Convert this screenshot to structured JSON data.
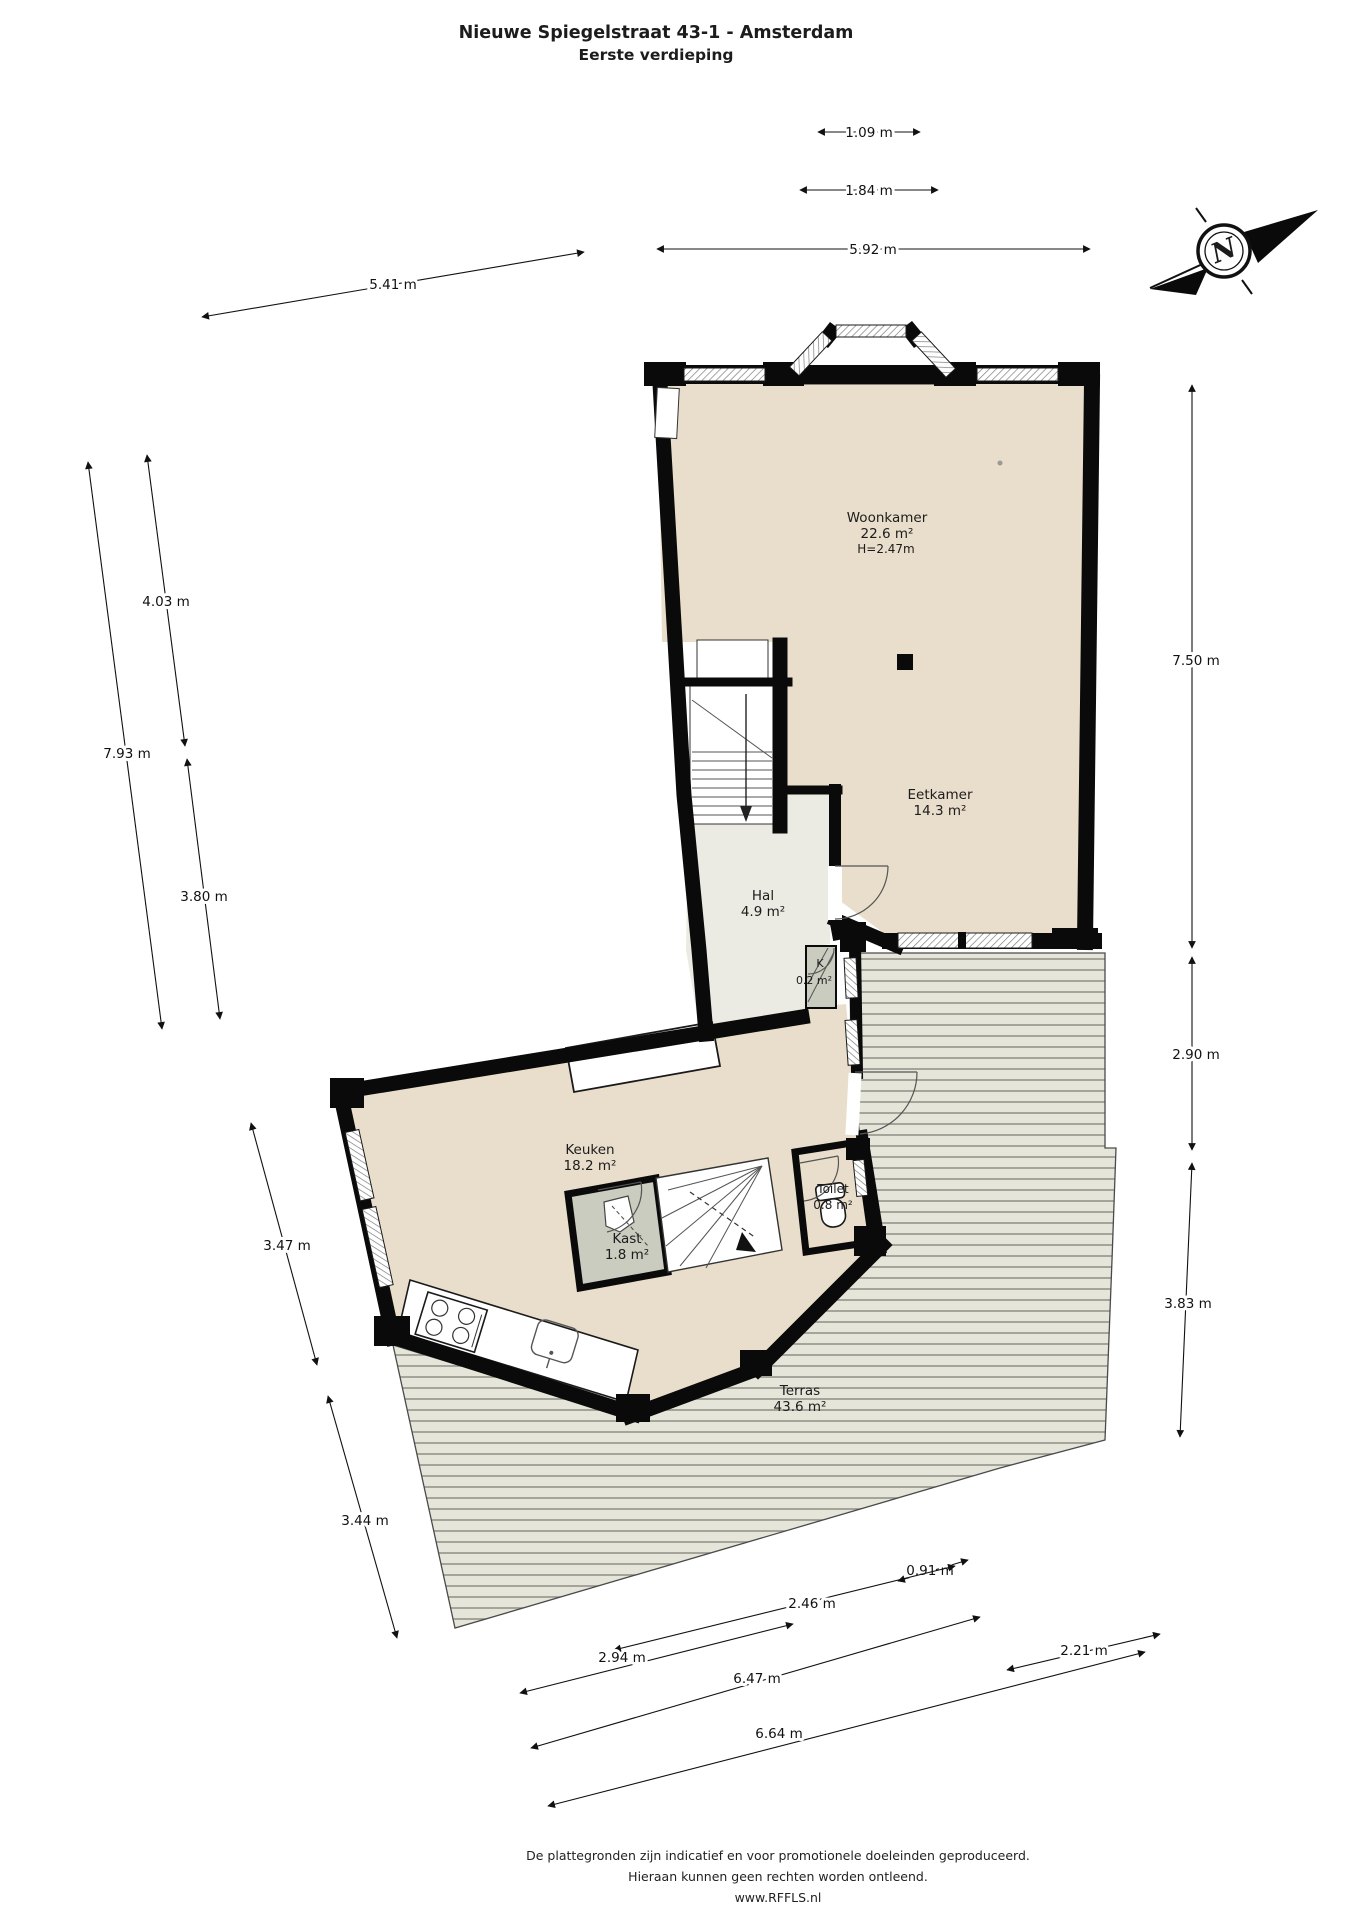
{
  "title": {
    "line1": "Nieuwe Spiegelstraat 43-1 - Amsterdam",
    "line2": "Eerste verdieping"
  },
  "compass": {
    "north_label": "N"
  },
  "rooms": {
    "woonkamer": {
      "name": "Woonkamer",
      "area": "22.6 m²",
      "height": "H=2.47m"
    },
    "eetkamer": {
      "name": "Eetkamer",
      "area": "14.3 m²"
    },
    "hal": {
      "name": "Hal",
      "area": "4.9 m²"
    },
    "k_closet": {
      "name": "K",
      "area": "0.2 m²"
    },
    "keuken": {
      "name": "Keuken",
      "area": "18.2 m²"
    },
    "kast": {
      "name": "Kast",
      "area": "1.8 m²"
    },
    "toilet": {
      "name": "Toilet",
      "area": "0.8 m²"
    },
    "terras": {
      "name": "Terras",
      "area": "43.6 m²"
    }
  },
  "dims": {
    "d109": "1.09 m",
    "d184": "1.84 m",
    "d592": "5.92 m",
    "d541": "5.41 m",
    "d750": "7.50 m",
    "d290": "2.90 m",
    "d383": "3.83 m",
    "d403": "4.03 m",
    "d793": "7.93 m",
    "d380": "3.80 m",
    "d347": "3.47 m",
    "d344": "3.44 m",
    "d091": "0.91 m",
    "d246": "2.46 m",
    "d294": "2.94 m",
    "d647": "6.47 m",
    "d221": "2.21 m",
    "d664": "6.64 m"
  },
  "footer": {
    "line1": "De plattegronden zijn indicatief en voor promotionele doeleinden geproduceerd.",
    "line2": "Hieraan kunnen geen rechten worden ontleend.",
    "line3": "www.RFFLS.nl"
  },
  "colors": {
    "wall": "#0a0a0a",
    "floor": "#e9decb",
    "hal_floor": "#ebeae3",
    "closet": "#c9ccbe",
    "terras_bg": "#e6e5da",
    "terras_line": "#8e8e84"
  }
}
